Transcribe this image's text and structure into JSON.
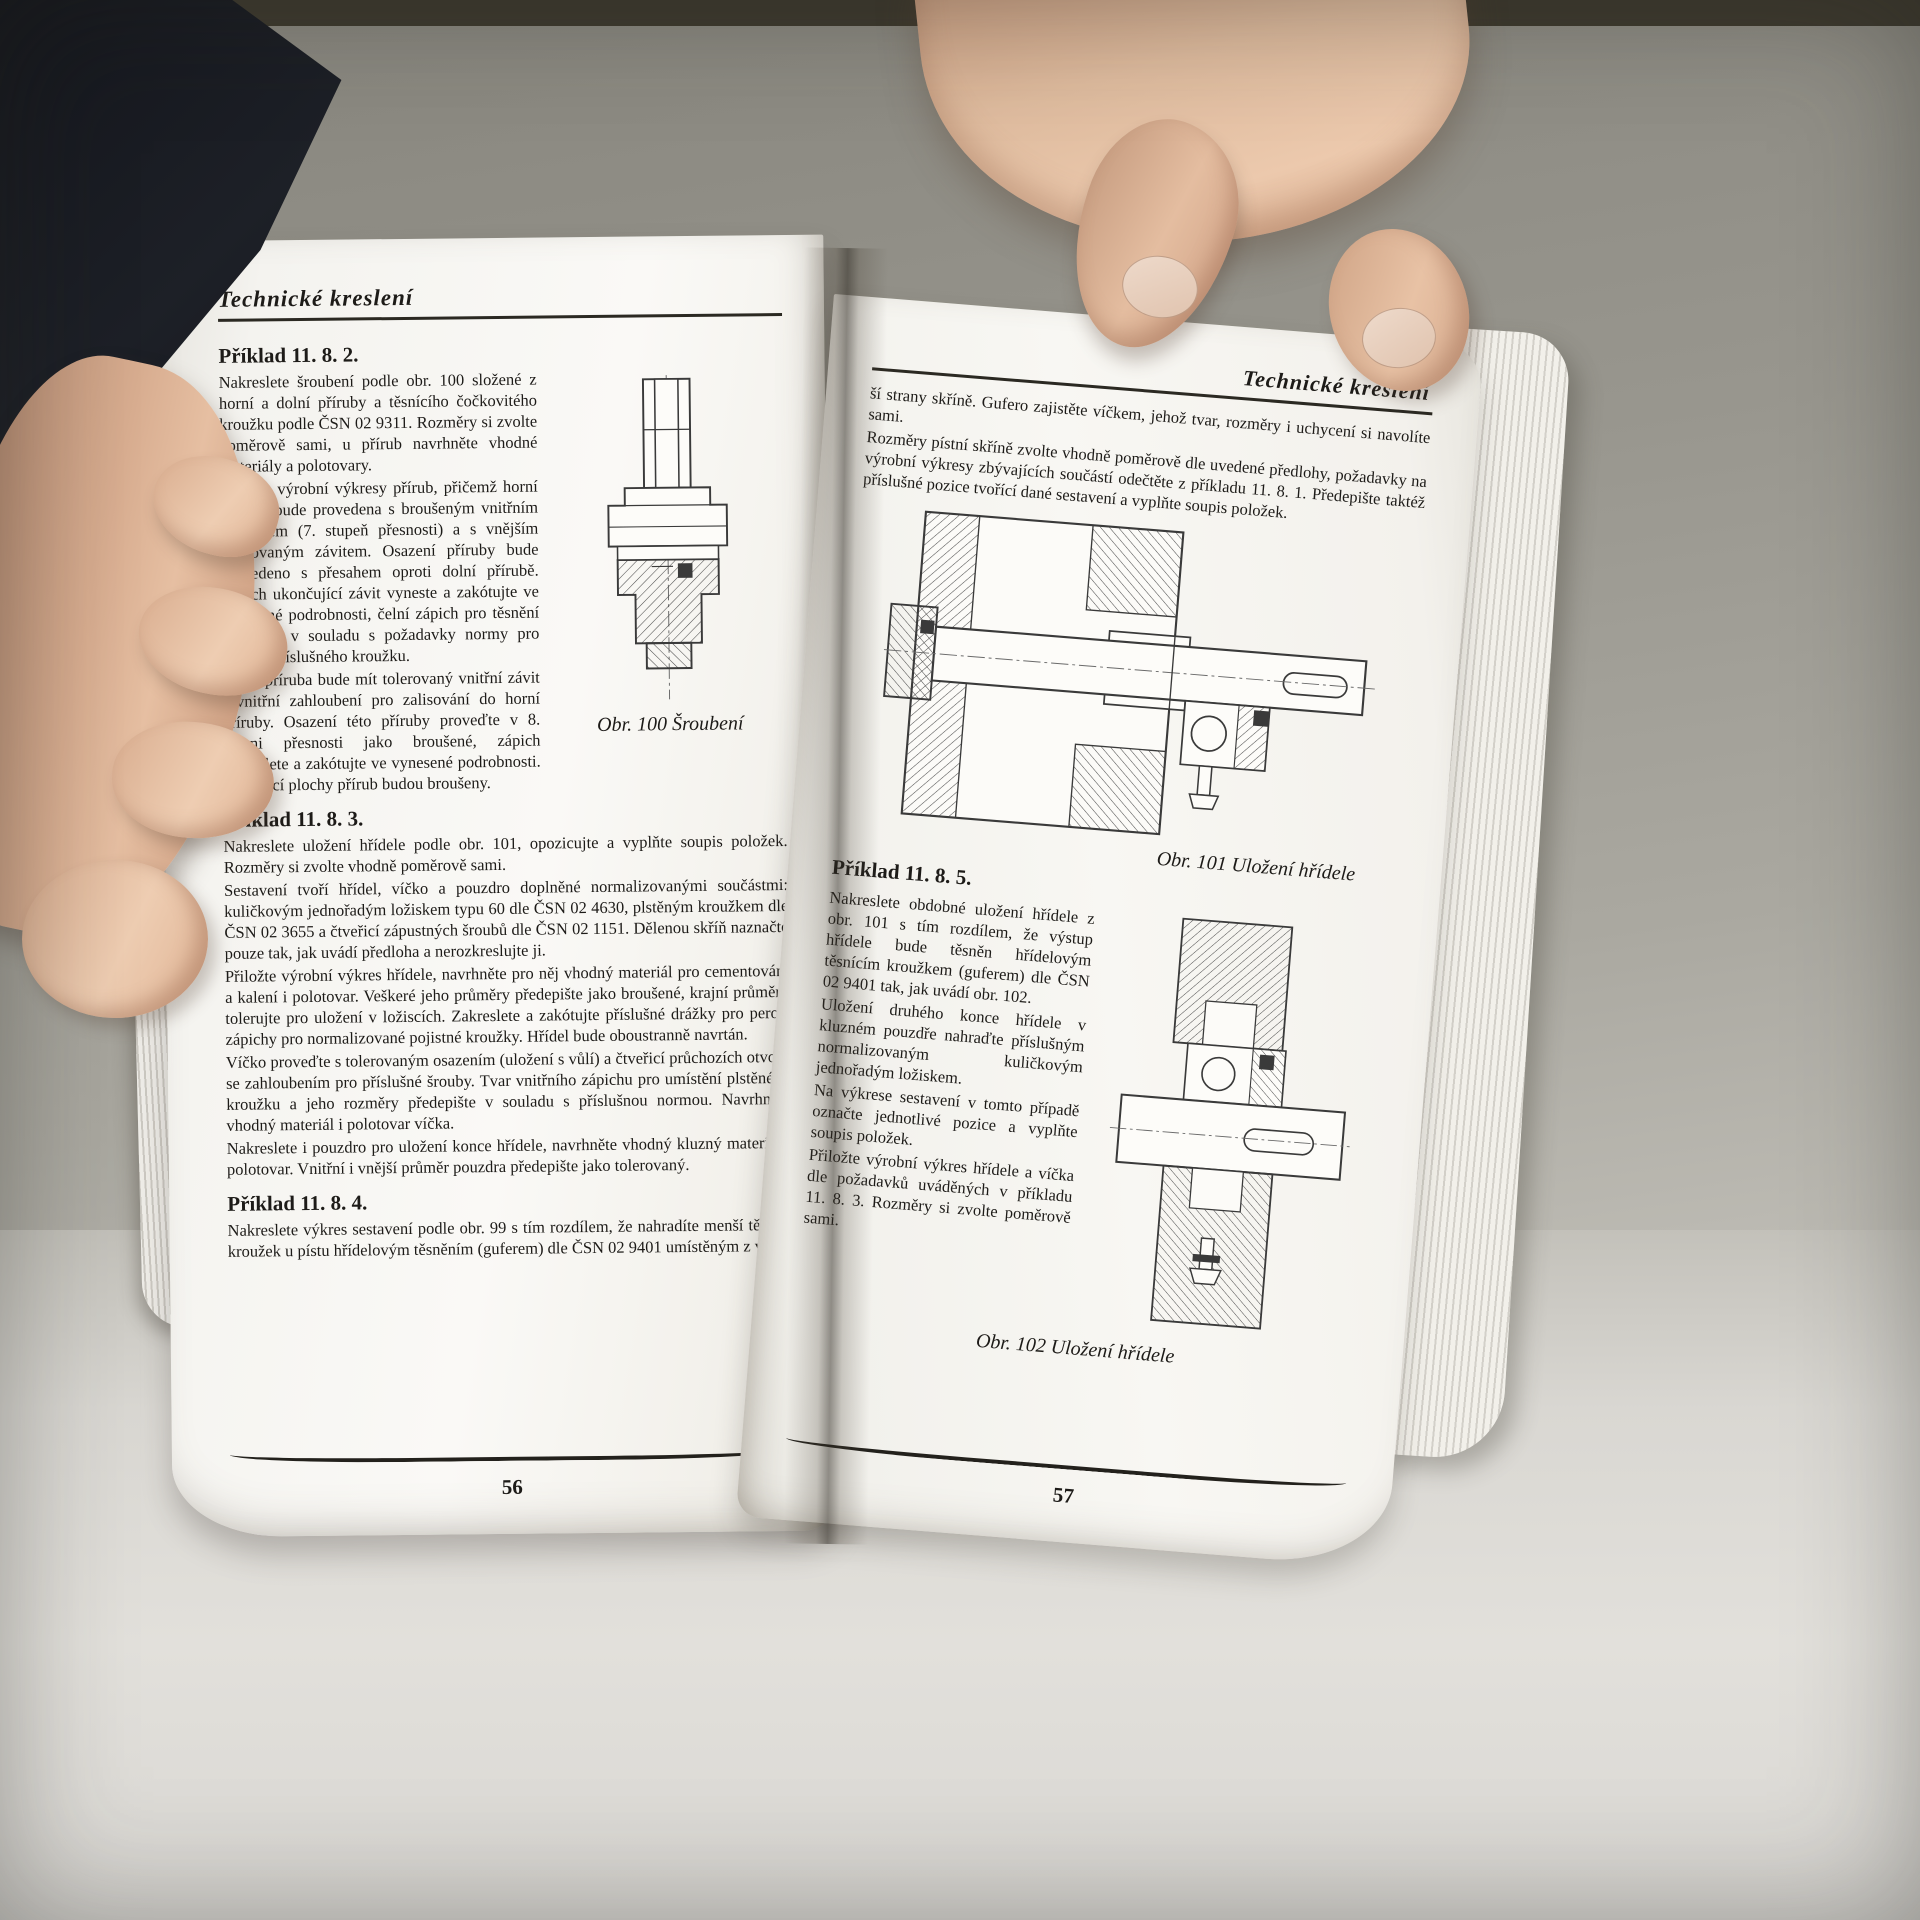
{
  "scene": {
    "description": "photo of an open technical-drawing textbook held by two hands",
    "colors": {
      "page": "#f8f7f3",
      "ink": "#1d1b18",
      "background_wall": "#98968e",
      "table_surface": "#dddbd6",
      "sleeve": "#1a1c22",
      "skin": "#e0b899"
    }
  },
  "left_page": {
    "header": "Technické kreslení",
    "page_number": "56",
    "figure100_caption": "Obr. 100 Šroubení",
    "sections": [
      {
        "heading": "Příklad 11. 8. 2.",
        "paragraphs": [
          "Nakreslete šroubení podle obr. 100 složené z horní a dolní příruby a těsnícího čočkovitého kroužku podle ČSN 02 9311. Rozměry si zvolte poměrově sami, u přírub navrhněte vhodné materiály a polotovary.",
          "Přiložte výrobní výkresy přírub, přičemž horní příruba bude provedena s broušeným vnitřním průměrem (7. stupeň přesnosti) a s vnějším tolerovaným závitem. Osazení příruby bude provedeno s přesahem oproti dolní přírubě. Zápich ukončující závit vyneste a zakótujte ve vynesené podrobnosti, čelní zápich pro těsnění proveďte v souladu s požadavky normy pro použití příslušného kroužku.",
          "Dolní příruba bude mít tolerovaný vnitřní závit i vnitřní zahloubení pro zalisování do horní příruby. Osazení této příruby proveďte v 8. stupni přesnosti jako broušené, zápich zakreslete a zakótujte ve vynesené podrobnosti. Dosedací plochy přírub budou broušeny."
        ]
      },
      {
        "heading": "Příklad 11. 8. 3.",
        "paragraphs": [
          "Nakreslete uložení hřídele podle obr. 101, opozicujte a vyplňte soupis položek. Rozměry si zvolte vhodně poměrově sami.",
          "Sestavení tvoří hřídel, víčko a pouzdro doplněné normalizovanými součástmi: kuličkovým jednořadým ložiskem typu 60 dle ČSN 02 4630, plstěným kroužkem dle ČSN 02 3655 a čtveřicí zápustných šroubů dle ČSN 02 1151. Dělenou skříň naznačte pouze tak, jak uvádí předloha a nerozkreslujte ji.",
          "Přiložte výrobní výkres hřídele, navrhněte pro něj vhodný materiál pro cementování a kalení i polotovar. Veškeré jeho průměry předepište jako broušené, krajní průměry tolerujte pro uložení v ložiscích. Zakreslete a zakótujte příslušné drážky pro pero i zápichy pro normalizované pojistné kroužky. Hřídel bude oboustranně navrtán.",
          "Víčko proveďte s tolerovaným osazením (uložení s vůlí) a čtveřicí průchozích otvorů se zahloubením pro příslušné šrouby. Tvar vnitřního zápichu pro umístění plstěného kroužku a jeho rozměry předepište v souladu s příslušnou normou. Navrhněte vhodný materiál i polotovar víčka.",
          "Nakreslete i pouzdro pro uložení konce hřídele, navrhněte vhodný kluzný materiál i polotovar. Vnitřní i vnější průměr pouzdra předepište jako tolerovaný."
        ]
      },
      {
        "heading": "Příklad 11. 8. 4.",
        "paragraphs": [
          "Nakreslete výkres sestavení podle obr. 99 s tím rozdílem, že nahradíte menší těsnící kroužek u pístu hřídelovým těsněním (guferem) dle ČSN 02 9401 umístěným z vněj-"
        ]
      }
    ]
  },
  "right_page": {
    "header": "Technické kreslení",
    "page_number": "57",
    "figure101_caption": "Obr. 101 Uložení hřídele",
    "figure102_caption": "Obr. 102 Uložení hřídele",
    "continued_paragraphs": [
      "ší strany skříně. Gufero zajistěte víčkem, jehož tvar, rozměry i uchycení si navolíte sami.",
      "Rozměry pístní skříně zvolte vhodně poměrově dle uvedené předlohy, požadavky na výrobní výkresy zbývajících součástí odečtěte z příkladu 11. 8. 1. Předepište taktéž příslušné pozice tvořící dané sestavení a vyplňte soupis položek."
    ],
    "section": {
      "heading": "Příklad 11. 8. 5.",
      "paragraphs": [
        "Nakreslete obdobné uložení hřídele z obr. 101 s tím rozdílem, že výstup hřídele bude těsněn hřídelovým těsnícím kroužkem (guferem) dle ČSN 02 9401 tak, jak uvádí obr. 102.",
        "Uložení druhého konce hřídele v kluzném pouzdře nahraďte příslušným normalizovaným kuličkovým jednořadým ložiskem.",
        "Na výkrese sestavení v tomto případě označte jednotlivé pozice a vyplňte soupis položek.",
        "Přiložte výrobní výkres hřídele a víčka dle požadavků uváděných v příkladu 11. 8. 3. Rozměry si zvolte poměrově sami."
      ]
    }
  }
}
